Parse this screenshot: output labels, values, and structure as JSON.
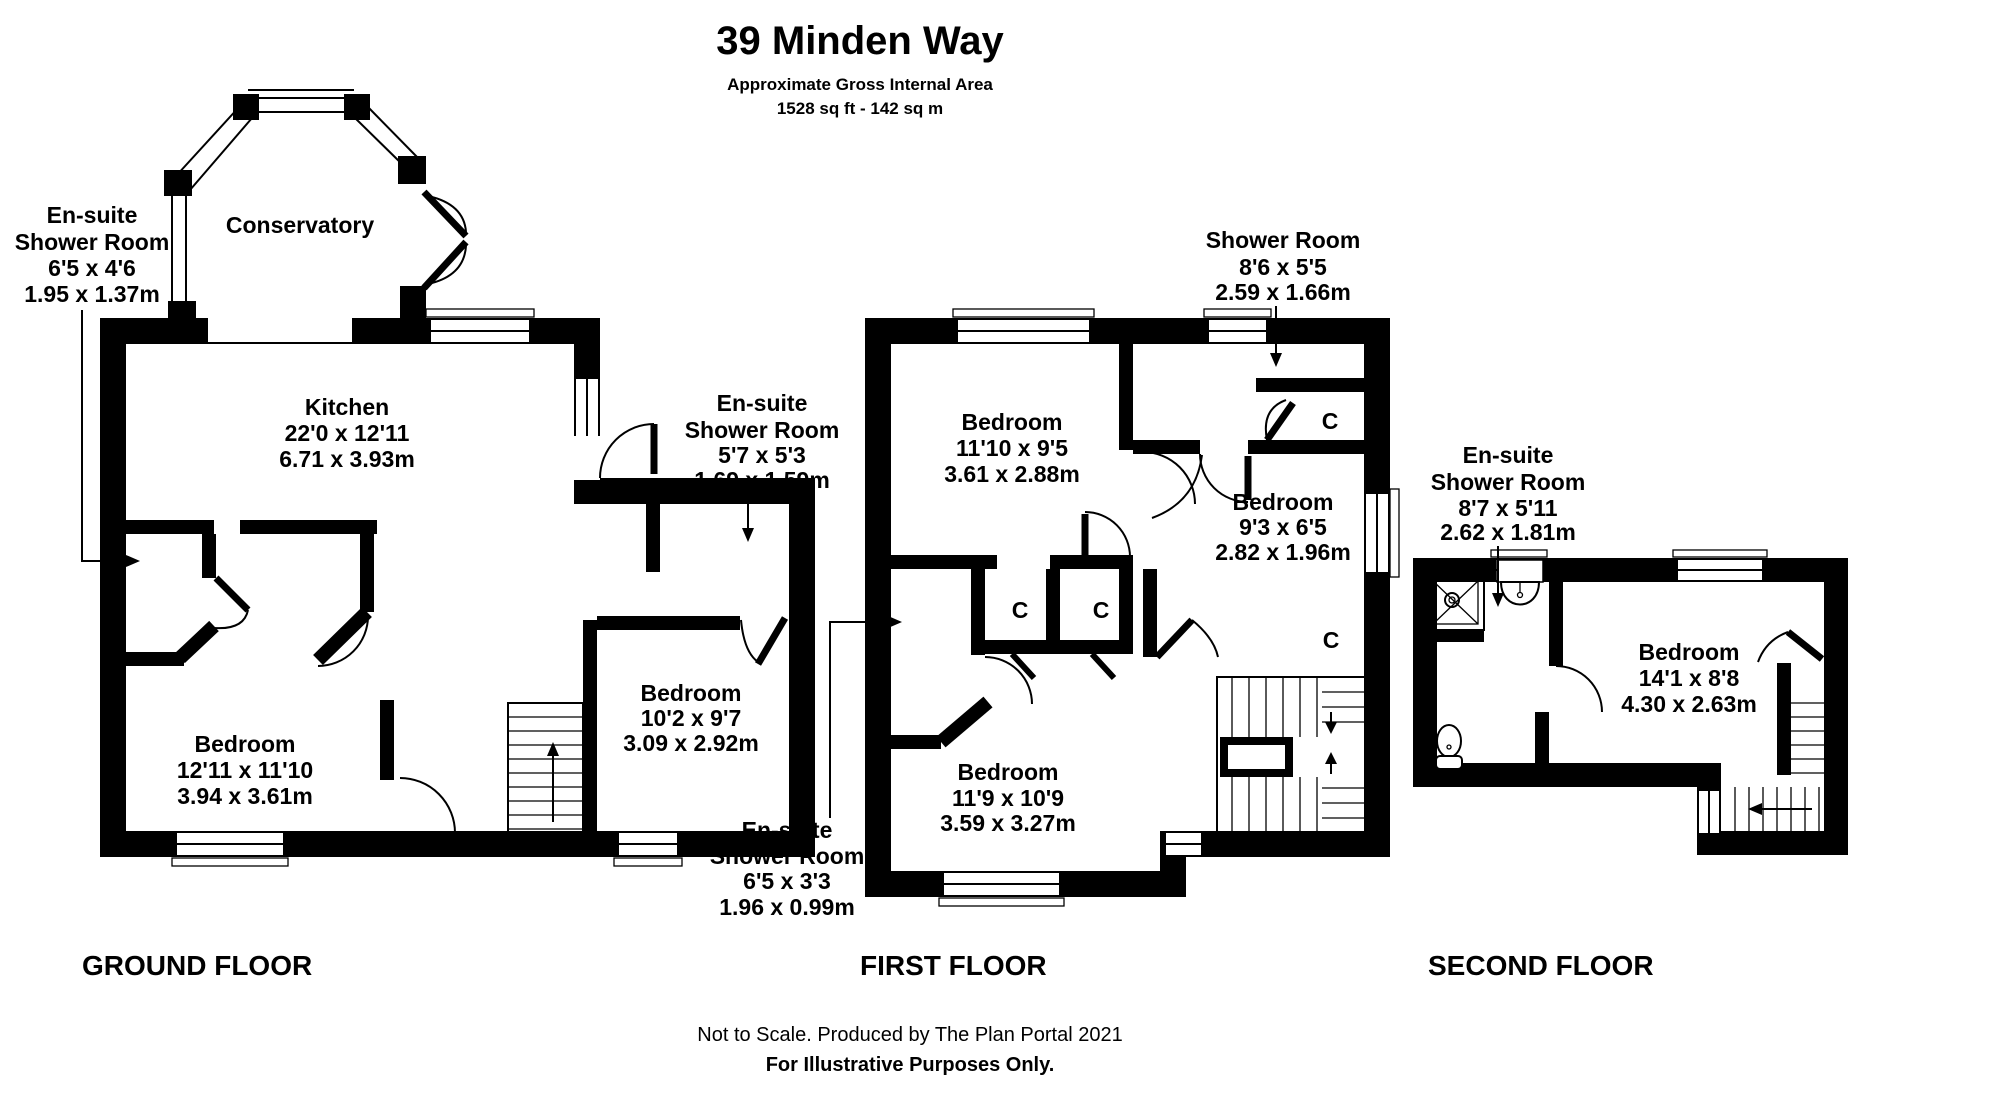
{
  "header": {
    "title": "39 Minden Way",
    "subtitle": "Approximate Gross Internal Area",
    "area": "1528 sq ft - 142 sq m"
  },
  "ground": {
    "label": "GROUND FLOOR",
    "conservatory": "Conservatory",
    "kitchen": {
      "lines": [
        "Kitchen",
        "22'0 x 12'11",
        "6.71 x 3.93m"
      ]
    },
    "ensuite_left": {
      "lines": [
        "En-suite",
        "Shower Room",
        "6'5 x 4'6",
        "1.95 x 1.37m"
      ]
    },
    "ensuite_right": {
      "lines": [
        "En-suite",
        "Shower Room",
        "5'7 x 5'3",
        "1.69 x 1.59m"
      ]
    },
    "bedroom_left": {
      "lines": [
        "Bedroom",
        "12'11 x 11'10",
        "3.94 x 3.61m"
      ]
    },
    "bedroom_right": {
      "lines": [
        "Bedroom",
        "10'2 x 9'7",
        "3.09 x 2.92m"
      ]
    }
  },
  "first": {
    "label": "FIRST FLOOR",
    "shower_room": {
      "lines": [
        "Shower Room",
        "8'6 x 5'5",
        "2.59 x 1.66m"
      ]
    },
    "bedroom_top": {
      "lines": [
        "Bedroom",
        "11'10 x 9'5",
        "3.61 x 2.88m"
      ]
    },
    "bedroom_right": {
      "lines": [
        "Bedroom",
        "9'3 x 6'5",
        "2.82 x 1.96m"
      ]
    },
    "bedroom_bottom": {
      "lines": [
        "Bedroom",
        "11'9 x 10'9",
        "3.59 x 3.27m"
      ]
    },
    "ensuite": {
      "lines": [
        "En-suite",
        "Shower Room",
        "6'5 x 3'3",
        "1.96 x 0.99m"
      ]
    }
  },
  "second": {
    "label": "SECOND FLOOR",
    "ensuite": {
      "lines": [
        "En-suite",
        "Shower Room",
        "8'7 x 5'11",
        "2.62 x 1.81m"
      ]
    },
    "bedroom": {
      "lines": [
        "Bedroom",
        "14'1 x 8'8",
        "4.30 x 2.63m"
      ]
    }
  },
  "closet_label": "C",
  "footer": {
    "line1": "Not to Scale. Produced by The Plan Portal 2021",
    "line2": "For Illustrative Purposes Only."
  },
  "colors": {
    "wall": "#000000",
    "background": "#ffffff"
  }
}
